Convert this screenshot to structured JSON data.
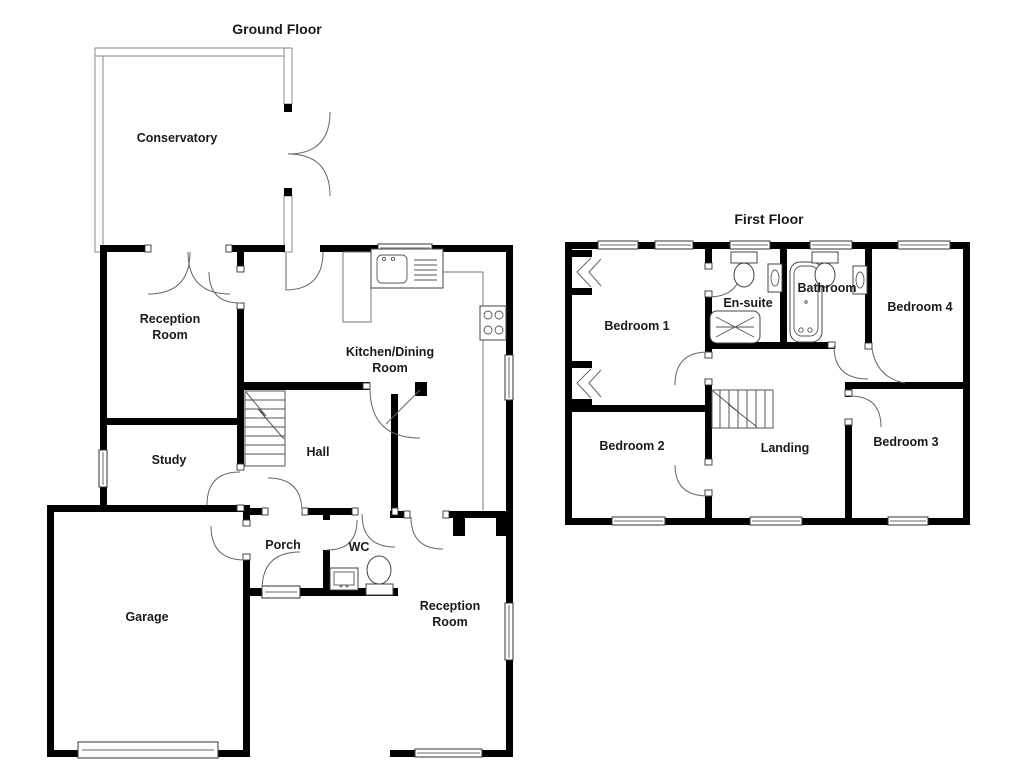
{
  "document": {
    "type": "house-floor-plan"
  },
  "ground_floor": {
    "title": "Ground Floor",
    "rooms": {
      "conservatory": "Conservatory",
      "reception_top_line1": "Reception",
      "reception_top_line2": "Room",
      "kitchen_line1": "Kitchen/Dining",
      "kitchen_line2": "Room",
      "study": "Study",
      "hall": "Hall",
      "porch": "Porch",
      "wc": "WC",
      "garage": "Garage",
      "reception_bottom_line1": "Reception",
      "reception_bottom_line2": "Room"
    }
  },
  "first_floor": {
    "title": "First Floor",
    "rooms": {
      "bedroom1": "Bedroom 1",
      "ensuite": "En-suite",
      "bathroom": "Bathroom",
      "bedroom4": "Bedroom 4",
      "bedroom2": "Bedroom 2",
      "landing": "Landing",
      "bedroom3": "Bedroom 3"
    }
  },
  "colors": {
    "wall": "#000000",
    "background": "#ffffff",
    "door_line": "#666666",
    "window_fill": "#ffffff",
    "glass_wall_stroke": "#8a8a8a"
  }
}
